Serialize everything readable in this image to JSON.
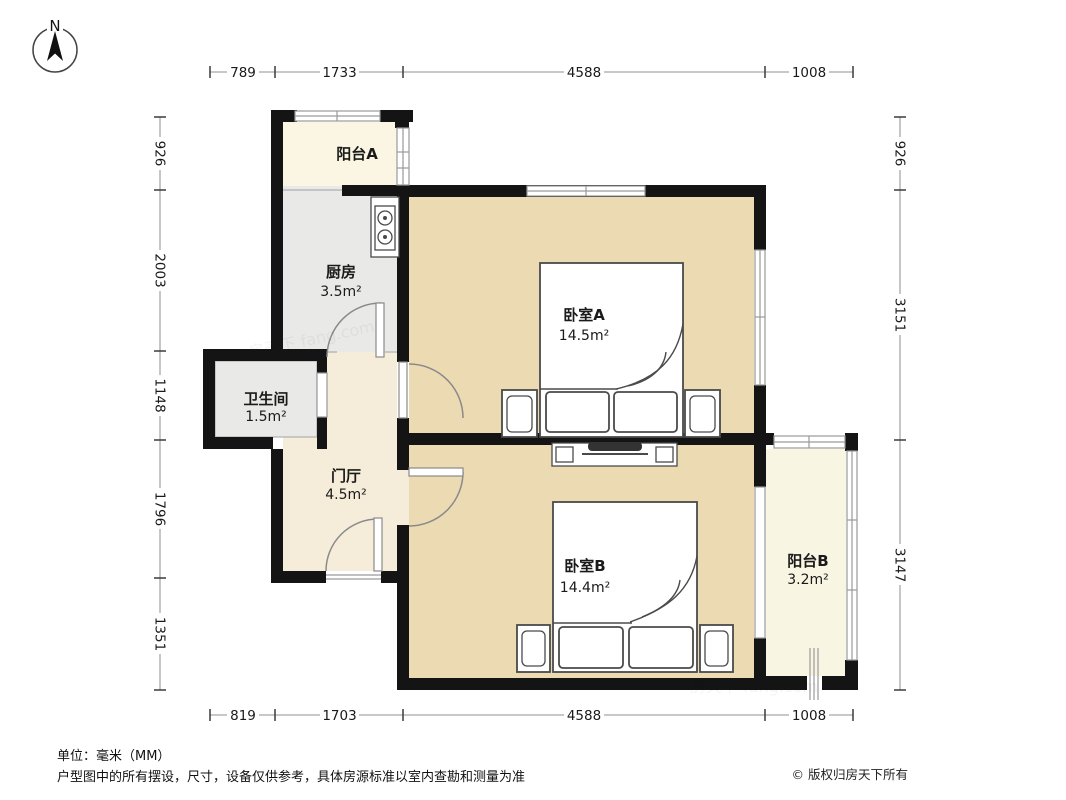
{
  "compass": {
    "label": "N"
  },
  "dimensions": {
    "top": [
      "789",
      "1733",
      "4588",
      "1008"
    ],
    "bottom": [
      "819",
      "1703",
      "4588",
      "1008"
    ],
    "left": [
      "926",
      "2003",
      "1148",
      "1796",
      "1351"
    ],
    "right": [
      "926",
      "3151",
      "3147"
    ]
  },
  "rooms": {
    "balcony_a": {
      "name": "阳台A"
    },
    "kitchen": {
      "name": "厨房",
      "area": "3.5m²"
    },
    "bedroom_a": {
      "name": "卧室A",
      "area": "14.5m²"
    },
    "bathroom": {
      "name": "卫生间",
      "area": "1.5m²"
    },
    "foyer": {
      "name": "门厅",
      "area": "4.5m²"
    },
    "bedroom_b": {
      "name": "卧室B",
      "area": "14.4m²"
    },
    "balcony_b": {
      "name": "阳台B",
      "area": "3.2m²"
    }
  },
  "footer": {
    "unit_note": "单位：毫米（MM）",
    "disclaimer": "户型图中的所有摆设，尺寸，设备仅供参考，具体房源标准以室内查勘和测量为准",
    "copyright": "© 版权归房天下所有"
  },
  "watermark": "房天下 fang.com",
  "colors": {
    "wall": "#141414",
    "bedroom_fill": "#ECDAB2",
    "balcony_fill": "#FAF6E3",
    "foyer_fill": "#F5EDDA",
    "utility_fill": "#E9E9E7",
    "window_line": "#9A9A9A",
    "dimension_line": "#A8A8A8"
  }
}
